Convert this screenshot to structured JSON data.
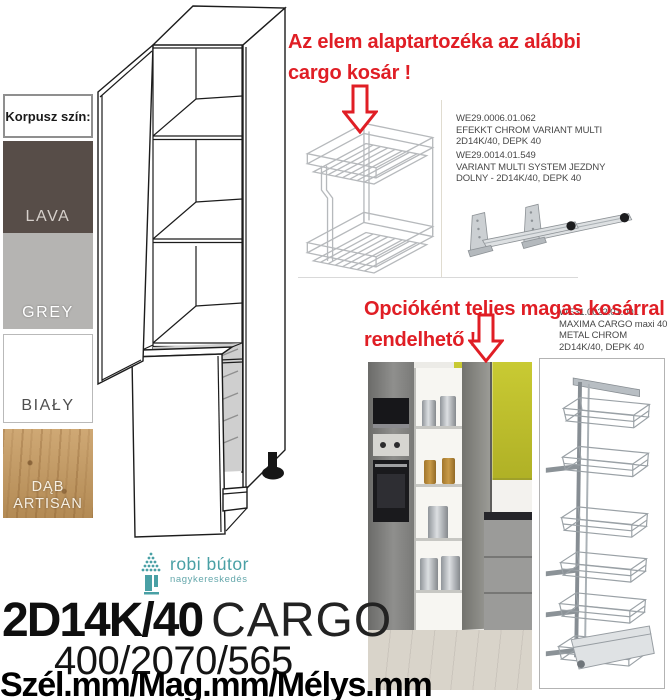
{
  "colors": {
    "accent_red": "#e01e25",
    "brand_teal": "#49a0a5",
    "kitchen_yellow": "#bcbd2f",
    "lava": "#574d48",
    "grey": "#b5b4b2",
    "bialy": "#ffffff",
    "dab_artisan": "#c79a5e"
  },
  "icons": {
    "arrow": "down-arrow-icon",
    "tree": "tree-icon"
  },
  "swatch_panel": {
    "header": "Korpusz szín:",
    "items": [
      {
        "label": "LAVA",
        "color": "#574d48",
        "label_color": "#d6d0cb"
      },
      {
        "label": "GREY",
        "color": "#b5b4b2",
        "label_color": "#ffffff"
      },
      {
        "label": "BIAŁY",
        "color": "#ffffff",
        "label_color": "#4f4f4f"
      },
      {
        "label": "DĄB ARTISAN",
        "color": "#c79a5e",
        "label_color": "#f6efe2"
      }
    ]
  },
  "notes": {
    "basic": {
      "line1": "Az elem alaptartozéka az alábbi",
      "line2": "cargo kosár !"
    },
    "optional": {
      "line1": "Opcióként teljes magas kosárral is",
      "line2": "rendelhető !"
    }
  },
  "products": [
    {
      "code": "WE29.0006.01.062",
      "line1": "EFEKKT CHROM VARIANT MULTI",
      "line2": "2D14K/40, DEPK 40"
    },
    {
      "code": "WE29.0014.01.549",
      "line1": "VARIANT MULTI SYSTEM JEZDNY",
      "line2": "DOLNY - 2D14K/40, DEPK 40"
    },
    {
      "code": "WE31.0022.01.001",
      "line1": "MAXIMA CARGO maxi 40",
      "line2": "METAL CHROM",
      "line3": "2D14K/40, DEPK 40"
    }
  ],
  "logo": {
    "name": "robi bútor",
    "subtitle": "nagykereskedés"
  },
  "title": {
    "model": "2D14K/40",
    "series": "CARGO",
    "dimensions": "400/2070/565",
    "dimension_labels": "Szél.mm/Mag.mm/Mélys.mm"
  }
}
